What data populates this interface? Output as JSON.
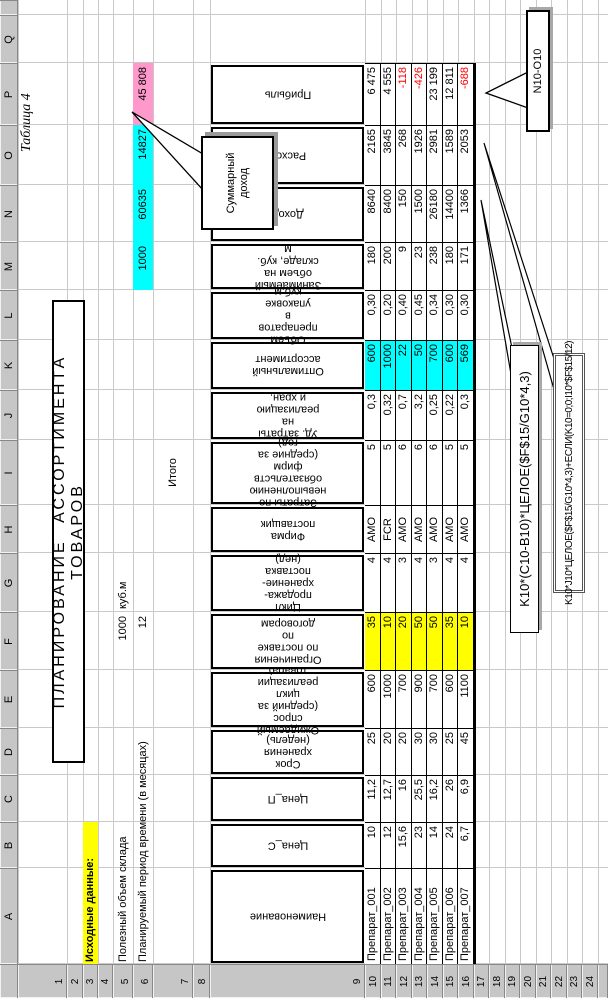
{
  "sheet": {
    "col_letters": [
      "A",
      "B",
      "C",
      "D",
      "E",
      "F",
      "G",
      "H",
      "I",
      "J",
      "K",
      "L",
      "M",
      "N",
      "O",
      "P",
      "Q",
      ""
    ],
    "row_numbers": [
      "1",
      "2",
      "3",
      "4",
      "5",
      "6",
      "7",
      "8",
      "9",
      "10",
      "11",
      "12",
      "13",
      "14",
      "15",
      "16",
      "17",
      "18",
      "19",
      "20",
      "21",
      "22",
      "23",
      "24",
      ""
    ]
  },
  "texts": {
    "tablica": "Таблица 4",
    "title": "ПЛАНИРОВАНИЕ АССОРТИМЕНТА ТОВАРОВ",
    "source_data_label": "Исходные данные:",
    "useful_volume_label": "Полезный объем склада",
    "useful_volume_value": "1000",
    "useful_volume_units": "куб.м",
    "period_label": "Планируемый период времени (в месяцах)",
    "period_value": "12",
    "itogo_label": "Итого"
  },
  "totals": {
    "volume": "1000",
    "dohod": "60635",
    "rashod": "14827",
    "pribyl": "45 808"
  },
  "callouts": {
    "sum_income": "Суммарный\nдоход",
    "profit_formula": "N10-O10",
    "income_formula": "K10*(C10-B10)*ЦЕЛОЕ($F$15/G10*4,3)",
    "expense_formula": "K10*J10*ЦЕЛОЕ($F$15/G10*4,3)+ЕСЛИ(K10=0;0;I10*$F$15/12)"
  },
  "table": {
    "headers": {
      "A": "Наименование",
      "B": "Цена_С",
      "C": "Цена_П",
      "D": "Срок хранения (недель)",
      "E": "Ожидаемый спрос\n(средний за цикл\nреализации товара)",
      "F": "Ограничения по поставке\nпо договорам",
      "G": "Цикл продажа-хранение-\nпоставка (нед)",
      "H": "Фирма поставщик",
      "I": "Затраты по\nневыполнению\nобязательств фирм\n(средние за год)",
      "J": "Уд. затраты на\nреализацию и хран.",
      "K": "Оптимальный\nассортимент",
      "L": "Объем препаратов в\nупаковке куб.м",
      "M": "Занимаемый объем на\nскладе, куб. м",
      "N": "Доход",
      "O": "Расход",
      "P": "Прибыль"
    },
    "rows": [
      {
        "A": "Препарат_001",
        "B": "10",
        "C": "11,2",
        "D": "25",
        "E": "600",
        "F": "35",
        "G": "4",
        "H": "АМО",
        "I": "5",
        "J": "0,3",
        "K": "600",
        "L": "0,30",
        "M": "180",
        "N": "8640",
        "O": "2165",
        "P": "6 475",
        "negative": false
      },
      {
        "A": "Препарат_002",
        "B": "12",
        "C": "12,7",
        "D": "20",
        "E": "1000",
        "F": "10",
        "G": "4",
        "H": "FCR",
        "I": "5",
        "J": "0,32",
        "K": "1000",
        "L": "0,20",
        "M": "200",
        "N": "8400",
        "O": "3845",
        "P": "4 555",
        "negative": false
      },
      {
        "A": "Препарат_003",
        "B": "15,6",
        "C": "16",
        "D": "20",
        "E": "700",
        "F": "20",
        "G": "3",
        "H": "АМО",
        "I": "6",
        "J": "0,7",
        "K": "22",
        "L": "0,40",
        "M": "9",
        "N": "150",
        "O": "268",
        "P": "-118",
        "negative": true
      },
      {
        "A": "Препарат_004",
        "B": "23",
        "C": "25,5",
        "D": "30",
        "E": "900",
        "F": "50",
        "G": "4",
        "H": "АМО",
        "I": "6",
        "J": "3,2",
        "K": "50",
        "L": "0,45",
        "M": "23",
        "N": "1500",
        "O": "1926",
        "P": "-426",
        "negative": true
      },
      {
        "A": "Препарат_005",
        "B": "14",
        "C": "16,2",
        "D": "30",
        "E": "700",
        "F": "50",
        "G": "3",
        "H": "АМО",
        "I": "6",
        "J": "0,25",
        "K": "700",
        "L": "0,34",
        "M": "238",
        "N": "26180",
        "O": "2981",
        "P": "23 199",
        "negative": false
      },
      {
        "A": "Препарат_006",
        "B": "24",
        "C": "26",
        "D": "25",
        "E": "600",
        "F": "35",
        "G": "4",
        "H": "АМО",
        "I": "5",
        "J": "0,22",
        "K": "600",
        "L": "0,30",
        "M": "180",
        "N": "14400",
        "O": "1589",
        "P": "12 811",
        "negative": false
      },
      {
        "A": "Препарат_007",
        "B": "6,7",
        "C": "6,9",
        "D": "45",
        "E": "1100",
        "F": "10",
        "G": "4",
        "H": "АМО",
        "I": "5",
        "J": "0,3",
        "K": "569",
        "L": "0,30",
        "M": "171",
        "N": "1366",
        "O": "2053",
        "P": "-688",
        "negative": true
      }
    ]
  },
  "colors": {
    "fill_cyan": "#00ffff",
    "fill_pink": "#ff99cc",
    "fill_yellow": "#ffff00",
    "negative_text": "#ff0000",
    "gridline": "#c9c9c9",
    "header_bg": "#c6c6c6"
  }
}
